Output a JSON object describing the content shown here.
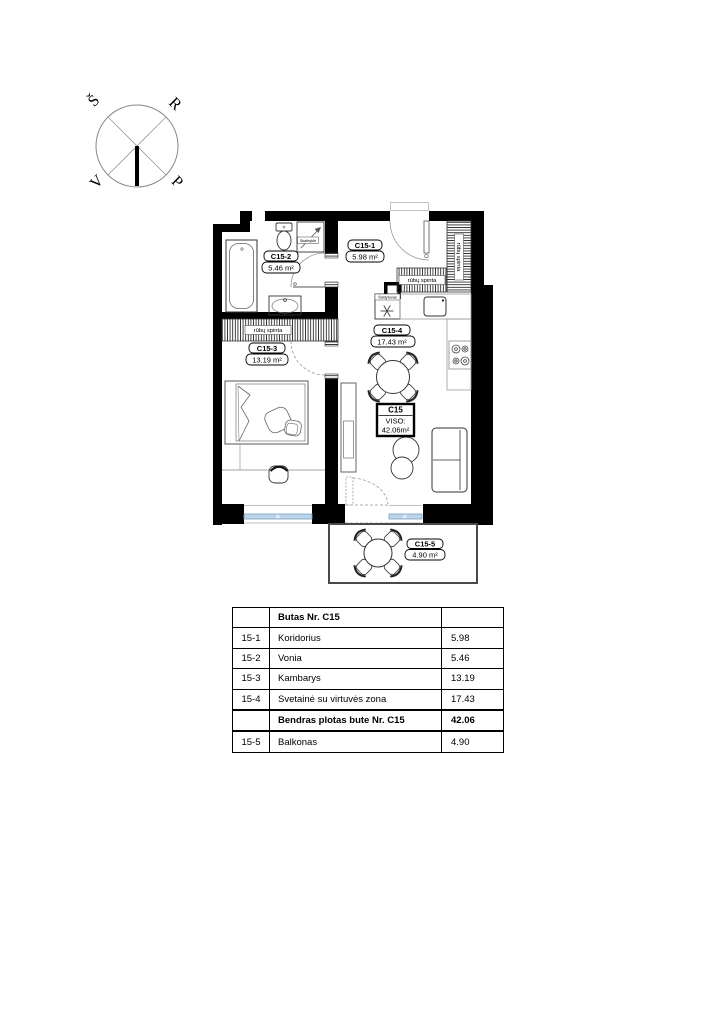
{
  "compass": {
    "nw": "Š",
    "ne": "R",
    "sw": "V",
    "se": "P"
  },
  "plan": {
    "room_labels": [
      {
        "id": "C15-1",
        "area": "5.98 m²"
      },
      {
        "id": "C15-2",
        "area": "5.46 m²"
      },
      {
        "id": "C15-3",
        "area": "13.19 m²"
      },
      {
        "id": "C15-4",
        "area": "17.43 m²"
      },
      {
        "id": "C15-5",
        "area": "4.90 m²"
      }
    ],
    "total_label": {
      "id": "C15",
      "viso": "VISO:",
      "area": "42.06m²"
    },
    "wardrobe": "rūbų spinta",
    "fridge": "Šaldytuvas",
    "washer": "Skalbyklė"
  },
  "table": {
    "title": "Butas Nr. C15",
    "rows": [
      {
        "no": "15-1",
        "name": "Koridorius",
        "area": "5.98"
      },
      {
        "no": "15-2",
        "name": "Vonia",
        "area": "5.46"
      },
      {
        "no": "15-3",
        "name": "Kambarys",
        "area": "13.19"
      },
      {
        "no": "15-4",
        "name": "Svetainė su virtuvės  zona",
        "area": "17.43"
      },
      {
        "no": "",
        "name": "Bendras plotas  bute Nr. C15",
        "area": "42.06"
      },
      {
        "no": "15-5",
        "name": "Balkonas",
        "area": "4.90"
      }
    ]
  },
  "colors": {
    "wall": "#000000",
    "window_glass": "#bcd4ea",
    "window_frame": "#7da0c4",
    "balcony_border": "#4a4a4a"
  }
}
